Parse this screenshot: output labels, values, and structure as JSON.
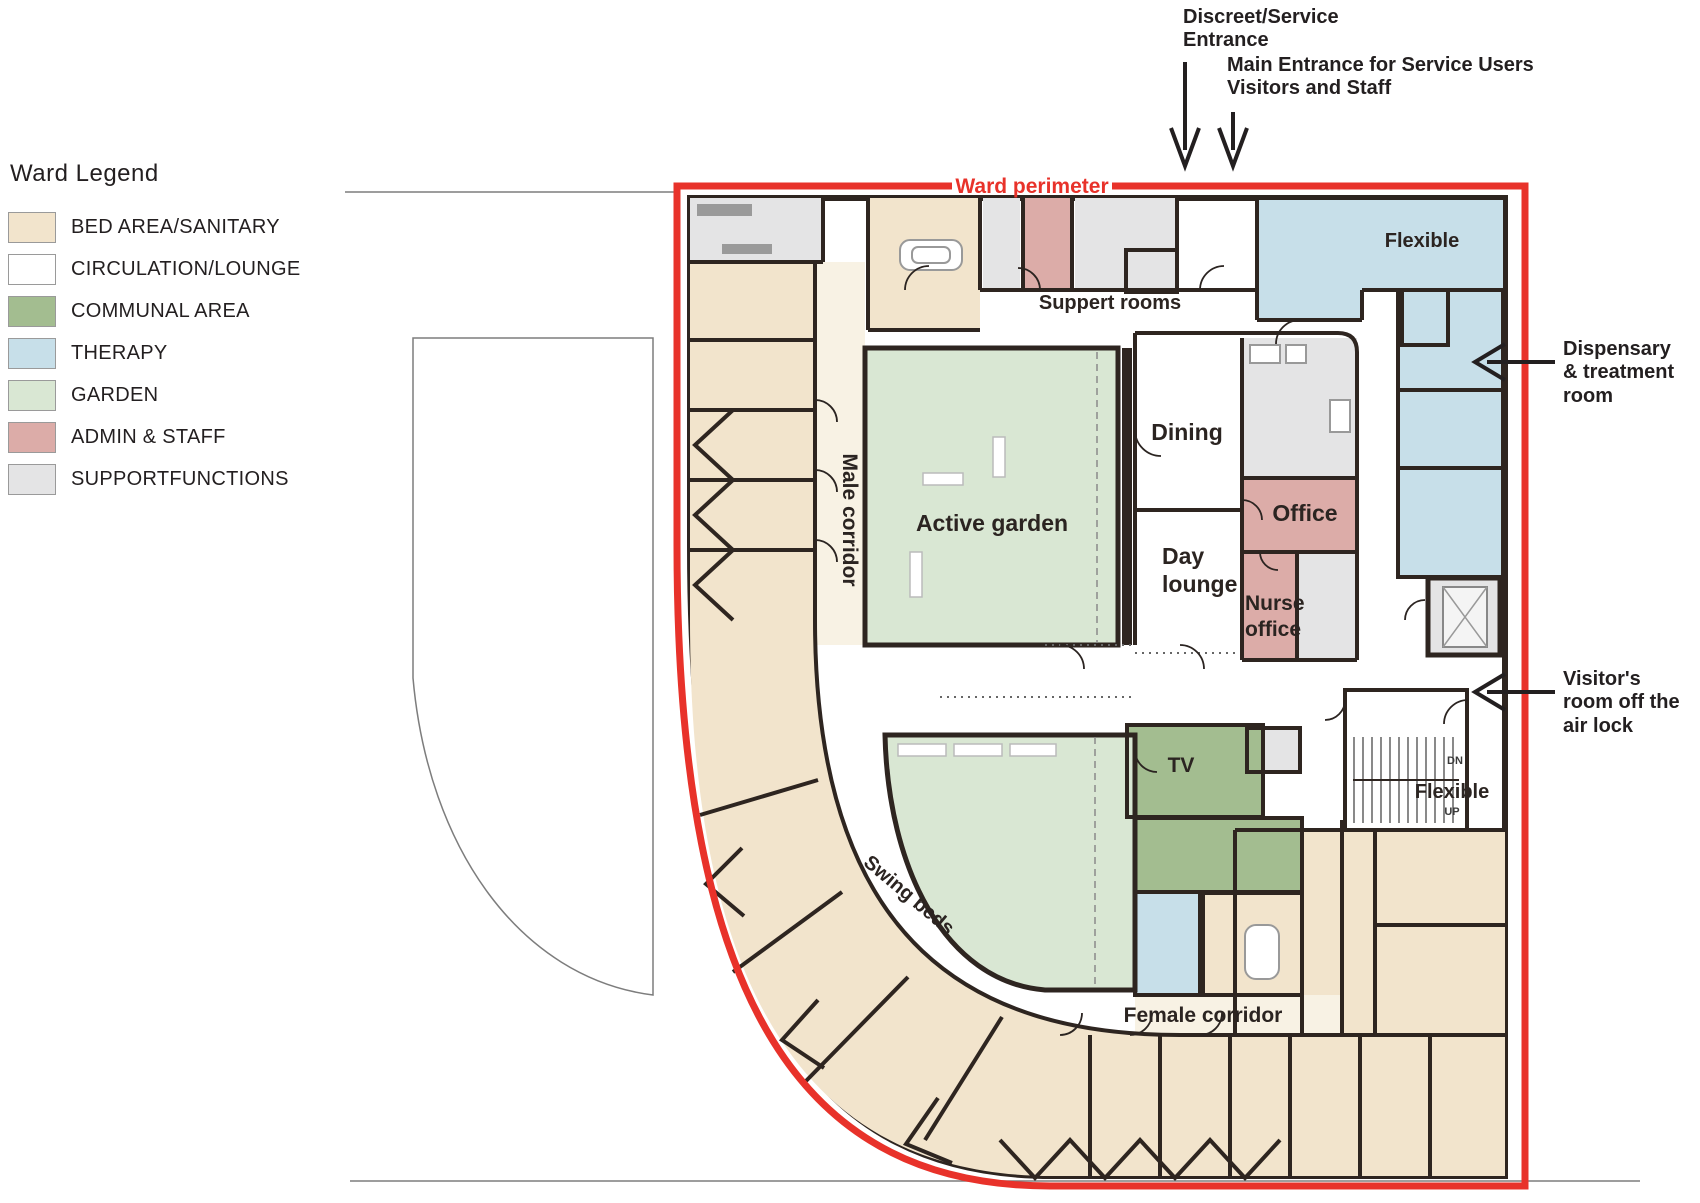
{
  "legend": {
    "title": "Ward Legend",
    "items": [
      {
        "label": "BED AREA/SANITARY",
        "color": "#f2e4cc"
      },
      {
        "label": "CIRCULATION/LOUNGE",
        "color": "#ffffff"
      },
      {
        "label": "COMMUNAL AREA",
        "color": "#a3bd90"
      },
      {
        "label": "THERAPY",
        "color": "#c7dfe9"
      },
      {
        "label": "GARDEN",
        "color": "#d9e7d3"
      },
      {
        "label": "ADMIN & STAFF",
        "color": "#dcaca8"
      },
      {
        "label": "SUPPORTFUNCTIONS",
        "color": "#e4e4e5"
      }
    ]
  },
  "annotations": {
    "ward_perimeter": "Ward perimeter",
    "discreet_entrance": "Discreet/Service\nEntrance",
    "main_entrance": "Main Entrance for Service Users\nVisitors and Staff",
    "dispensary": "Dispensary\n& treatment\nroom",
    "visitors_room": "Visitor's\nroom off the\nair lock"
  },
  "rooms": {
    "suppert_rooms": "Suppert rooms",
    "flexible_top": "Flexible",
    "dining": "Dining",
    "active_garden": "Active garden",
    "office": "Office",
    "day_lounge_line1": "Day",
    "day_lounge_line2": "lounge",
    "nurse_office_line1": "Nurse",
    "nurse_office_line2": "office",
    "male_corridor": "Male corridor",
    "tv": "TV",
    "flexible_stairs": "Flexible",
    "stairs_dn": "DN",
    "stairs_up": "UP",
    "swing_beds": "Swing beds",
    "female_corridor": "Female corridor"
  },
  "colors": {
    "bed": "#f2e4cc",
    "bed_corridor_tint": "#f8f2e4",
    "circulation": "#ffffff",
    "communal": "#a3bd90",
    "therapy": "#c7dfe9",
    "garden": "#d9e7d3",
    "admin": "#dcaca8",
    "support": "#e4e4e5",
    "wall": "#2e2520",
    "perimeter_red": "#e8322a",
    "annotation_ink": "#231f20"
  }
}
